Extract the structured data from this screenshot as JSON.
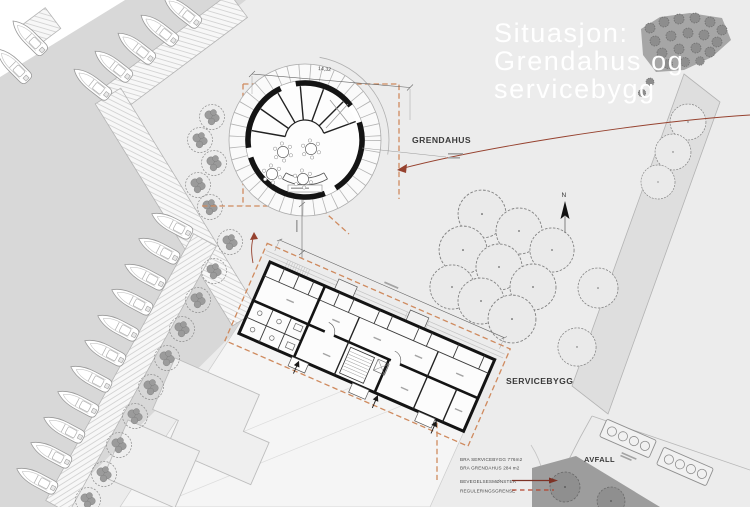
{
  "title": {
    "lines": [
      "Situasjon:",
      "Grendahus og",
      "servicebygg"
    ]
  },
  "map_labels": {
    "grendahus": "GRENDAHUS",
    "servicebygg": "SERVICEBYGG",
    "avfall": "AVFALL",
    "north": "N"
  },
  "dimensions": {
    "grendahus_width": "14,32"
  },
  "legend": {
    "bra_lines": [
      "BRA SERVICEBYGG 776m2",
      "BRA GRENDAHUS 284 m2"
    ],
    "movement_label": "BEVEGELSESMØNSTER",
    "boundary_label": "REGULERINGSGRENSE"
  },
  "colors": {
    "water": "#d8d8d8",
    "land": "#ececec",
    "building_walls": "#141414",
    "regulation_boundary_dash": "#cf8a5e",
    "movement_arrow": "#96422f",
    "dark_vegetation": "#9d9d9d",
    "title_text": "#ffffff",
    "label_text": "#3a3a3a"
  },
  "icons": {
    "north_arrow": "north-arrow",
    "tree": "tree-canopy",
    "boat": "boat-top-view",
    "waste_container": "waste-container-row"
  }
}
